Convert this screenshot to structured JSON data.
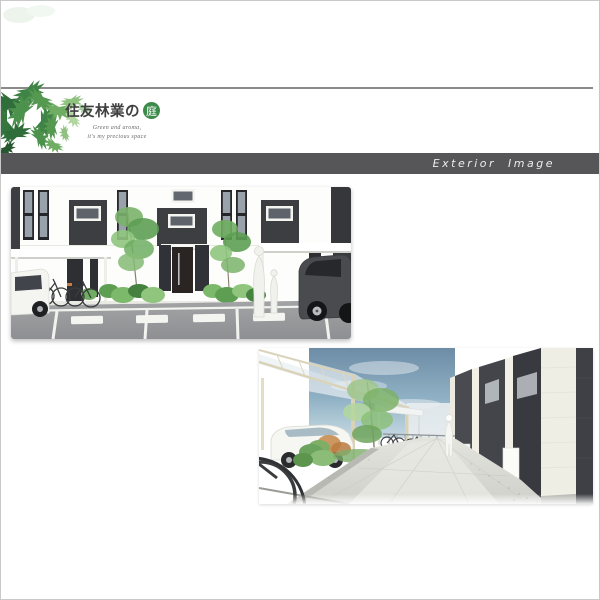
{
  "page": {
    "background": "#ffffff",
    "border_color": "#c9c9c9"
  },
  "header": {
    "divider_color": "#8a8a8a",
    "logo": {
      "brand_text": "住友林業の",
      "badge_text": "庭",
      "tagline_line1": "Green and aroma,",
      "tagline_line2": "it's my precious space",
      "badge_color": "#3d8b4b",
      "text_color": "#3f3f3f",
      "foliage_icon": "leaf-cluster"
    },
    "title_bar": {
      "label": "Exterior Image",
      "background_color": "#565659",
      "text_color": "#ededed"
    }
  },
  "renderings": {
    "front": {
      "name": "front-elevation-rendering"
    },
    "walkway": {
      "name": "walkway-perspective-rendering"
    }
  }
}
